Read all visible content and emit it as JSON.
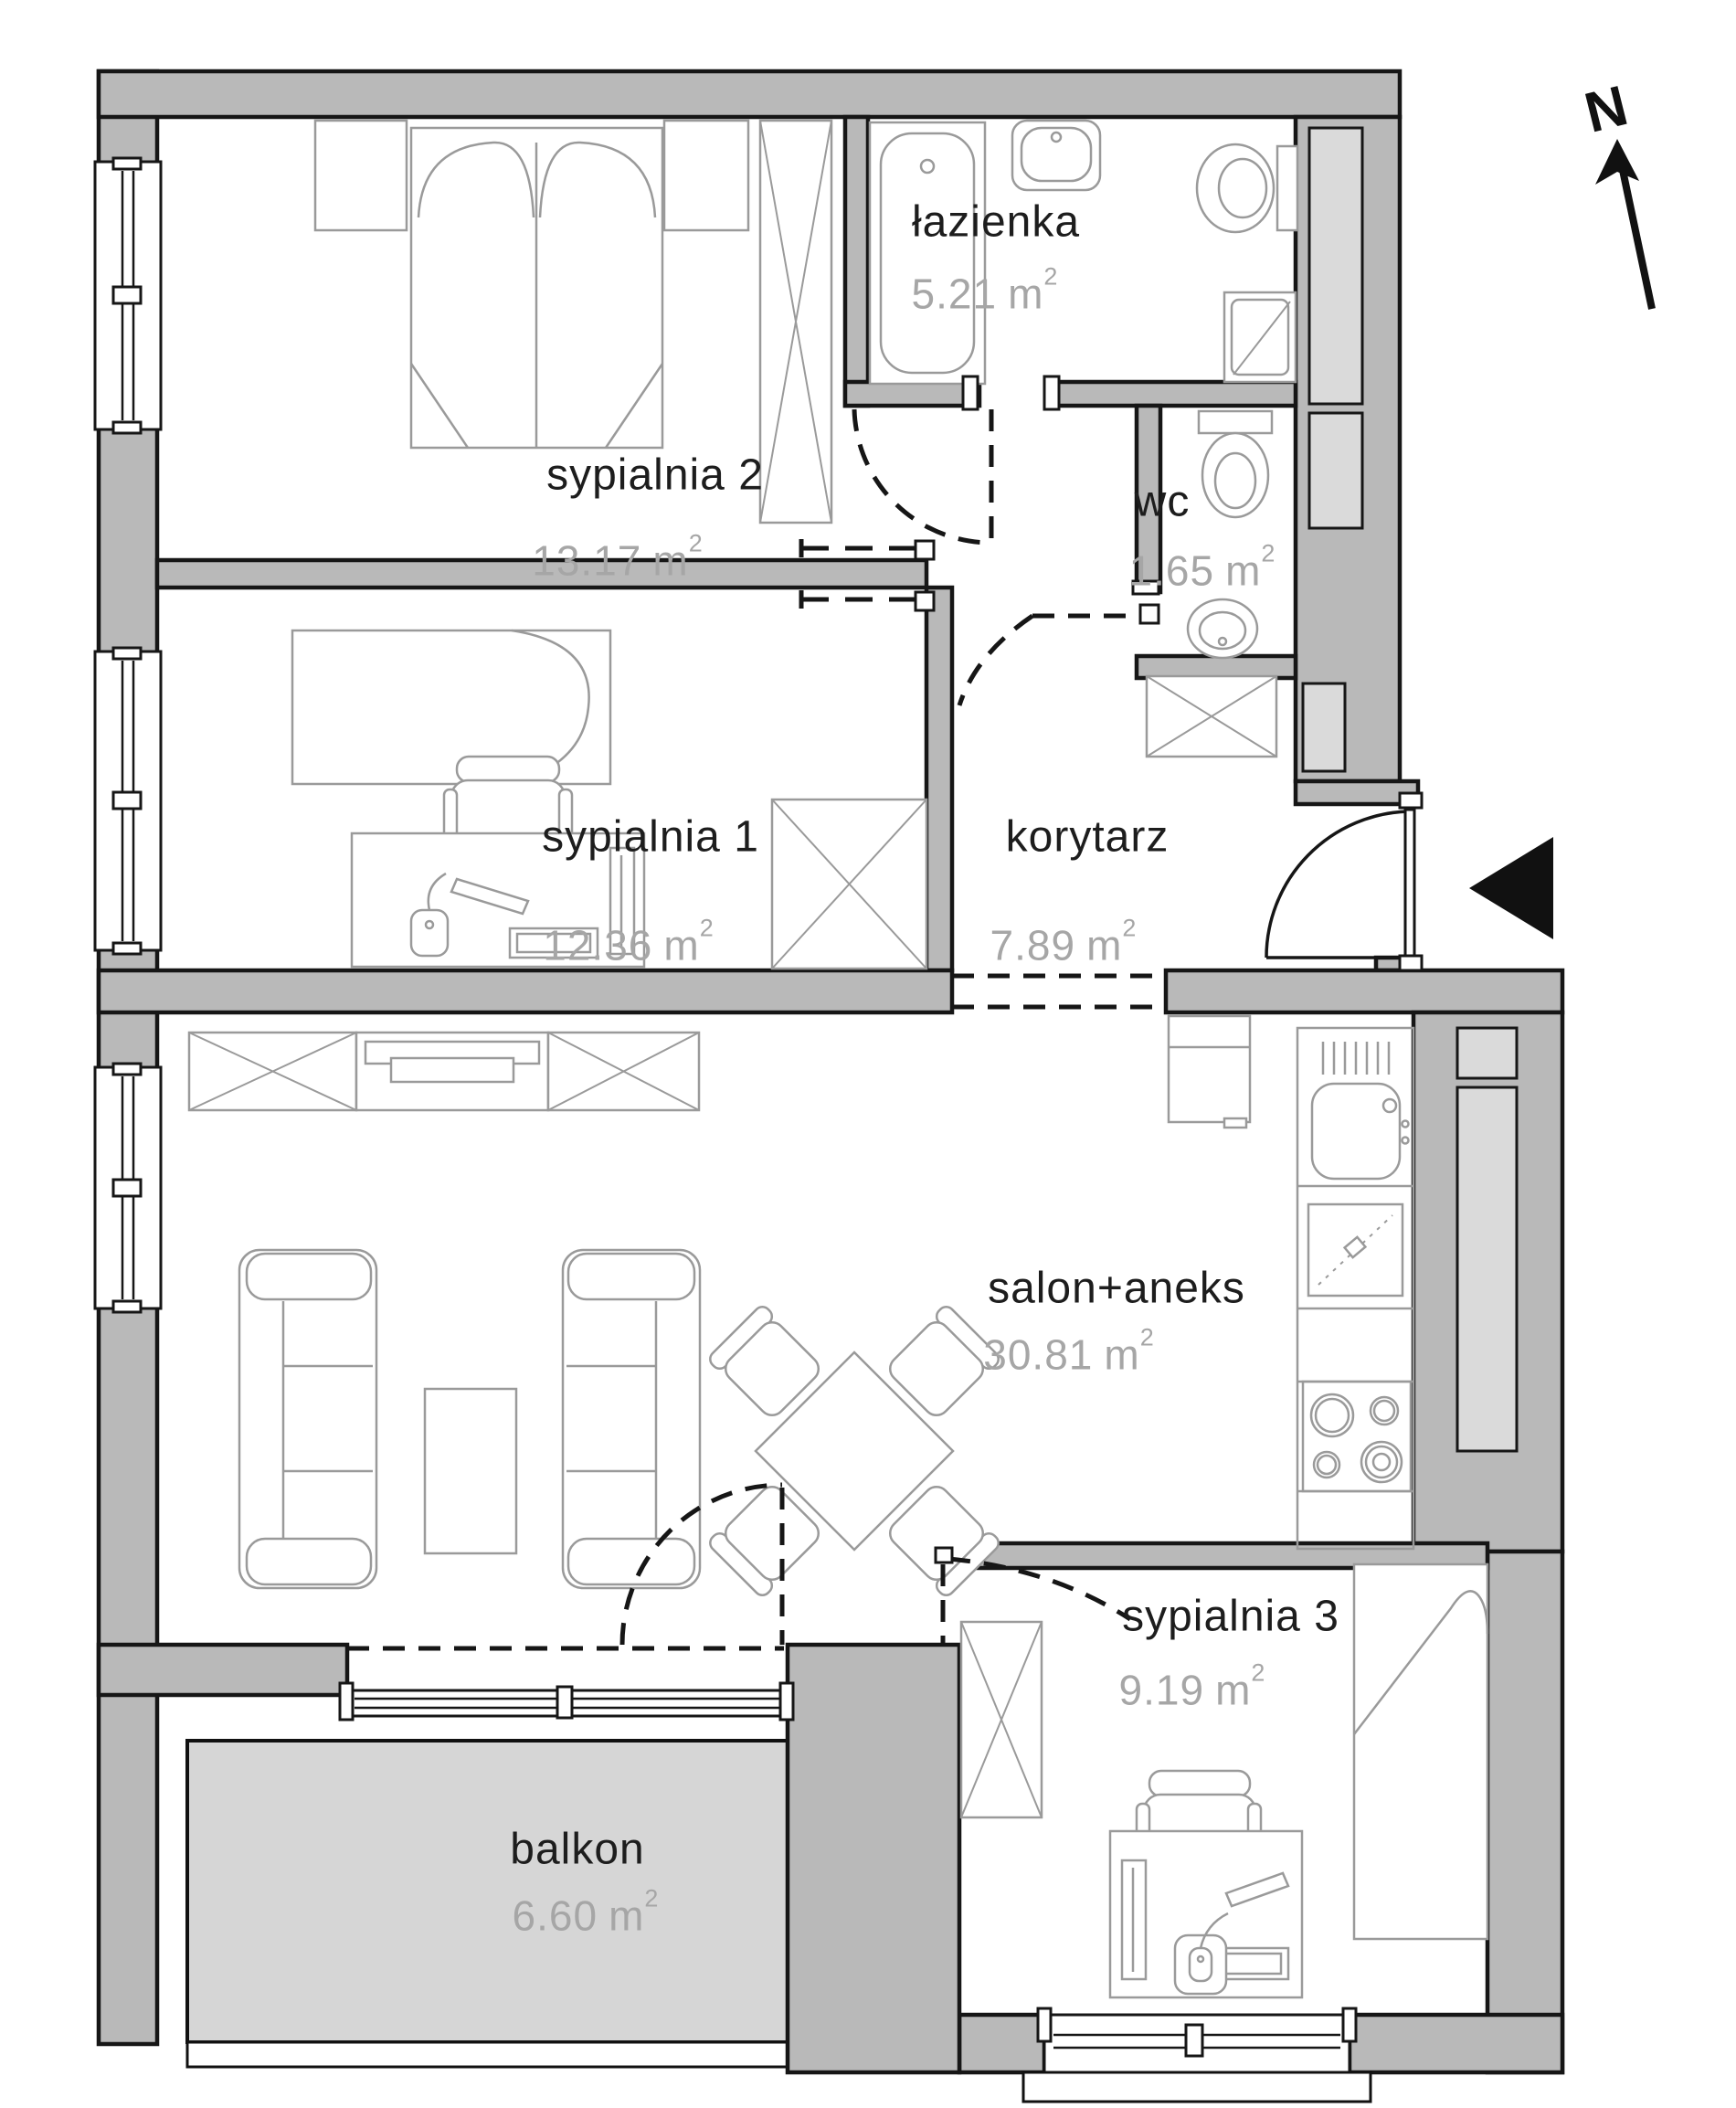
{
  "plan": {
    "title": "apartment-floor-plan",
    "north_label": "N",
    "unit": "m",
    "sup": "2",
    "rooms": [
      {
        "key": "sypialnia2",
        "name": "sypialnia 2",
        "area": "13.17"
      },
      {
        "key": "lazienka",
        "name": "łazienka",
        "area": "5.21"
      },
      {
        "key": "wc",
        "name": "wc",
        "area": "1.65"
      },
      {
        "key": "sypialnia1",
        "name": "sypialnia 1",
        "area": "12.36"
      },
      {
        "key": "korytarz",
        "name": "korytarz",
        "area": "7.89"
      },
      {
        "key": "salon",
        "name": "salon+aneks",
        "area": "30.81"
      },
      {
        "key": "sypialnia3",
        "name": "sypialnia 3",
        "area": "9.19"
      },
      {
        "key": "balkon",
        "name": "balkon",
        "area": "6.60"
      }
    ],
    "colors": {
      "wall": "#b9b9b9",
      "shaft": "#dadada",
      "balcony": "#d6d6d6",
      "line": "#161616",
      "furniture": "#9a9a9a",
      "room_name_text": "#1d1d1d",
      "area_text": "#a6a6a6"
    }
  }
}
